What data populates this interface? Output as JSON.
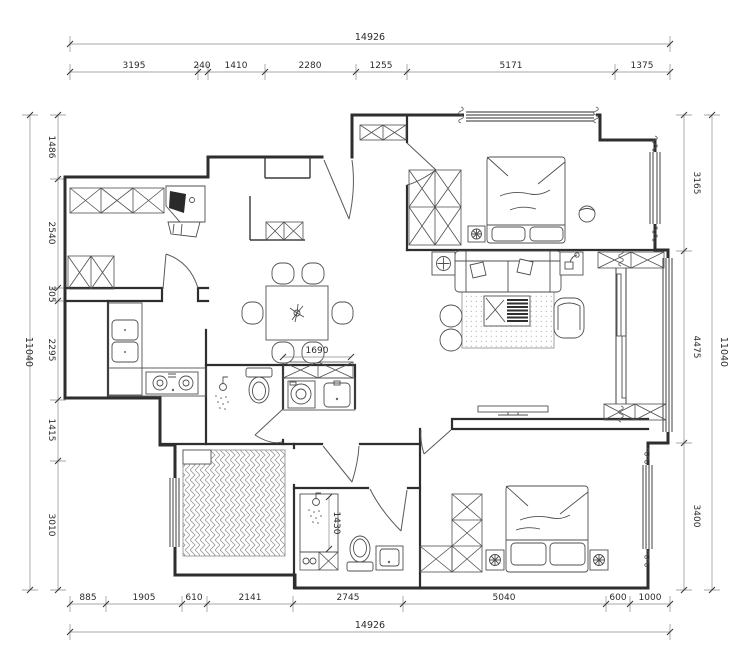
{
  "drawing": {
    "kind": "residential apartment floor plan"
  },
  "dimensions": {
    "top": {
      "overall": "14926",
      "segments": [
        "3195",
        "240",
        "1410",
        "2280",
        "1255",
        "5171",
        "1375"
      ]
    },
    "bottom": {
      "overall": "14926",
      "segments": [
        "885",
        "1905",
        "610",
        "2141",
        "2745",
        "5040",
        "600",
        "1000"
      ]
    },
    "left": {
      "overall": "11040",
      "segments": [
        "1486",
        "2540",
        "305",
        "2295",
        "1415",
        "3010"
      ]
    },
    "right": {
      "overall": "11040",
      "segments": [
        "3165",
        "4475",
        "3400"
      ]
    },
    "interior": {
      "laundry_counter": "1690",
      "shower_room": "1430"
    }
  },
  "colors": {
    "wall": "#2e2e2e",
    "furniture": "#4f4f4f",
    "dimension_line": "#8a8a8a",
    "text": "#2b2b2b",
    "background": "#ffffff"
  }
}
